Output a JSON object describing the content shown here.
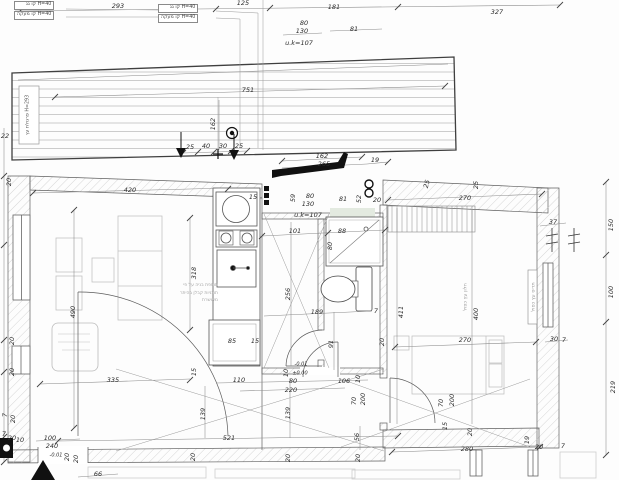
{
  "drawing": {
    "kind": "architectural floor plan",
    "units": "cm",
    "line_color": "#5a5a5a",
    "new_construction_color": "#111111",
    "furniture_color": "#c2c2c2"
  },
  "texts": {
    "h40_line1": "H=40 קו גג",
    "h40_line2": "H=40 קו מעקה",
    "pergola_label": "פרגולת עץ",
    "pergola_height": "H=293",
    "note_lines": [
      "תוספת בניה על פי",
      "תוכניות קבלן בהיתר",
      "מאושרת"
    ]
  },
  "annotations": [
    {
      "t": "293",
      "x": 118,
      "y": 6
    },
    {
      "t": "125",
      "x": 243,
      "y": 3
    },
    {
      "t": "181",
      "x": 334,
      "y": 7
    },
    {
      "t": "327",
      "x": 497,
      "y": 12
    },
    {
      "t": "81",
      "x": 354,
      "y": 29
    },
    {
      "t": "80",
      "x": 304,
      "y": 23
    },
    {
      "t": "130",
      "x": 302,
      "y": 31
    },
    {
      "t": "u.k=107",
      "x": 299,
      "y": 43
    },
    {
      "t": "751",
      "x": 248,
      "y": 90
    },
    {
      "t": "162",
      "x": 213,
      "y": 124,
      "r": -90
    },
    {
      "t": "22",
      "x": 5,
      "y": 136
    },
    {
      "t": "25",
      "x": 190,
      "y": 147
    },
    {
      "t": "40",
      "x": 206,
      "y": 146
    },
    {
      "t": "30",
      "x": 223,
      "y": 146
    },
    {
      "t": "25",
      "x": 239,
      "y": 146
    },
    {
      "t": "162",
      "x": 322,
      "y": 156
    },
    {
      "t": "265",
      "x": 324,
      "y": 164
    },
    {
      "t": "19",
      "x": 375,
      "y": 160
    },
    {
      "t": "15",
      "x": 253,
      "y": 197
    },
    {
      "t": "59",
      "x": 293,
      "y": 198,
      "r": -90
    },
    {
      "t": "80",
      "x": 310,
      "y": 196
    },
    {
      "t": "130",
      "x": 308,
      "y": 204
    },
    {
      "t": "u.k=107",
      "x": 308,
      "y": 215
    },
    {
      "t": "81",
      "x": 343,
      "y": 199
    },
    {
      "t": "52",
      "x": 359,
      "y": 199,
      "r": -90
    },
    {
      "t": "20",
      "x": 377,
      "y": 200
    },
    {
      "t": "25",
      "x": 427,
      "y": 184,
      "r": -75
    },
    {
      "t": "25",
      "x": 476,
      "y": 185,
      "r": -90
    },
    {
      "t": "270",
      "x": 465,
      "y": 198
    },
    {
      "t": "37",
      "x": 553,
      "y": 222
    },
    {
      "t": "20",
      "x": 9,
      "y": 182,
      "r": -90
    },
    {
      "t": "420",
      "x": 130,
      "y": 190
    },
    {
      "t": "101",
      "x": 295,
      "y": 231
    },
    {
      "t": "88",
      "x": 342,
      "y": 231
    },
    {
      "t": "80",
      "x": 330,
      "y": 246,
      "r": -90
    },
    {
      "t": "256",
      "x": 288,
      "y": 294,
      "r": -90
    },
    {
      "t": "318",
      "x": 194,
      "y": 273,
      "r": -90
    },
    {
      "t": "490",
      "x": 73,
      "y": 312,
      "r": -90
    },
    {
      "t": "189",
      "x": 317,
      "y": 312
    },
    {
      "t": "7",
      "x": 376,
      "y": 311
    },
    {
      "t": "91",
      "x": 331,
      "y": 344,
      "r": -90
    },
    {
      "t": "20",
      "x": 382,
      "y": 342,
      "r": -90
    },
    {
      "t": "85",
      "x": 232,
      "y": 341
    },
    {
      "t": "15",
      "x": 255,
      "y": 341
    },
    {
      "t": "411",
      "x": 401,
      "y": 312,
      "r": -90
    },
    {
      "t": "400",
      "x": 476,
      "y": 314,
      "r": -90
    },
    {
      "t": "270",
      "x": 465,
      "y": 340
    },
    {
      "t": "335",
      "x": 113,
      "y": 380
    },
    {
      "t": "15",
      "x": 194,
      "y": 372,
      "r": -90
    },
    {
      "t": "110",
      "x": 239,
      "y": 380
    },
    {
      "t": "10",
      "x": 286,
      "y": 373,
      "r": -90
    },
    {
      "t": "-0.01",
      "x": 301,
      "y": 365,
      "s": 5
    },
    {
      "t": "±0.00",
      "x": 300,
      "y": 374,
      "s": 5
    },
    {
      "t": "80",
      "x": 293,
      "y": 381
    },
    {
      "t": "220",
      "x": 291,
      "y": 390
    },
    {
      "t": "106",
      "x": 344,
      "y": 381
    },
    {
      "t": "10",
      "x": 358,
      "y": 379,
      "r": -90
    },
    {
      "t": "70",
      "x": 354,
      "y": 401,
      "r": -90
    },
    {
      "t": "200",
      "x": 363,
      "y": 399,
      "r": -90
    },
    {
      "t": "139",
      "x": 203,
      "y": 414,
      "r": -90
    },
    {
      "t": "139",
      "x": 288,
      "y": 413,
      "r": -90
    },
    {
      "t": "521",
      "x": 229,
      "y": 438
    },
    {
      "t": "70",
      "x": 441,
      "y": 403,
      "r": -90
    },
    {
      "t": "200",
      "x": 452,
      "y": 400,
      "r": -90
    },
    {
      "t": "15",
      "x": 445,
      "y": 426,
      "r": -90
    },
    {
      "t": "56",
      "x": 357,
      "y": 437,
      "r": -90
    },
    {
      "t": "100",
      "x": 50,
      "y": 438
    },
    {
      "t": "240",
      "x": 52,
      "y": 446
    },
    {
      "t": "-0.01",
      "x": 56,
      "y": 456,
      "s": 5
    },
    {
      "t": "20",
      "x": 76,
      "y": 459,
      "r": -90
    },
    {
      "t": "20",
      "x": 12,
      "y": 341,
      "r": -90
    },
    {
      "t": "20",
      "x": 12,
      "y": 372,
      "r": -90
    },
    {
      "t": "7",
      "x": 5,
      "y": 415,
      "r": -90
    },
    {
      "t": "20",
      "x": 13,
      "y": 419,
      "r": -90
    },
    {
      "t": "7",
      "x": 4,
      "y": 434
    },
    {
      "t": "20",
      "x": 12,
      "y": 438
    },
    {
      "t": "10",
      "x": 20,
      "y": 440
    },
    {
      "t": "66",
      "x": 98,
      "y": 474
    },
    {
      "t": "20",
      "x": 67,
      "y": 457,
      "r": -90
    },
    {
      "t": "20",
      "x": 193,
      "y": 457,
      "r": -90
    },
    {
      "t": "20",
      "x": 288,
      "y": 458,
      "r": -90
    },
    {
      "t": "20",
      "x": 358,
      "y": 458,
      "r": -90
    },
    {
      "t": "280",
      "x": 467,
      "y": 449
    },
    {
      "t": "19",
      "x": 527,
      "y": 440,
      "r": -90
    },
    {
      "t": "20",
      "x": 539,
      "y": 447
    },
    {
      "t": "7",
      "x": 563,
      "y": 446
    },
    {
      "t": "20",
      "x": 470,
      "y": 432,
      "r": -90
    },
    {
      "t": "30",
      "x": 554,
      "y": 339
    },
    {
      "t": "7",
      "x": 564,
      "y": 340
    },
    {
      "t": "150",
      "x": 611,
      "y": 225,
      "r": -90
    },
    {
      "t": "100",
      "x": 611,
      "y": 292,
      "r": -90
    },
    {
      "t": "219",
      "x": 613,
      "y": 387,
      "r": -90
    },
    {
      "t": "חלון עץ כפול",
      "x": 466,
      "y": 297,
      "r": -90,
      "s": 5,
      "c": "gray"
    },
    {
      "t": "תריס עץ כפול",
      "x": 534,
      "y": 297,
      "r": -90,
      "s": 5,
      "c": "gray"
    }
  ]
}
